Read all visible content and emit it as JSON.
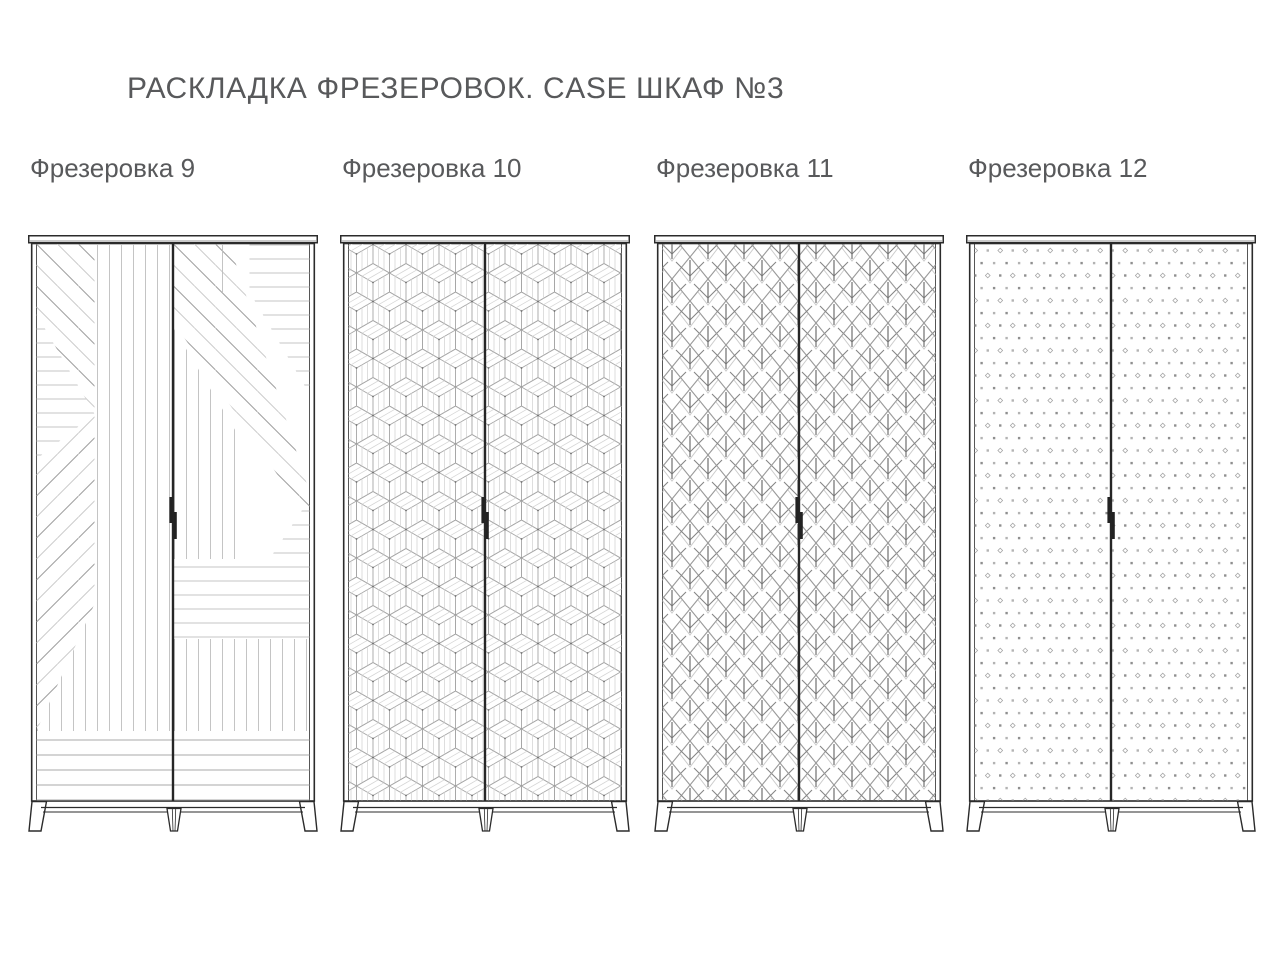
{
  "page": {
    "title": "РАСКЛАДКА ФРЕЗЕРОВОК. CASE ШКАФ №3",
    "background": "#ffffff"
  },
  "wardrobes": [
    {
      "label": "Фрезеровка 9",
      "pattern_name": "mixed-stripe-patchwork"
    },
    {
      "label": "Фрезеровка 10",
      "pattern_name": "isometric-cubes"
    },
    {
      "label": "Фрезеровка 11",
      "pattern_name": "art-deco-leaf-chevrons"
    },
    {
      "label": "Фрезеровка 12",
      "pattern_name": "dot-and-diamond-grid"
    }
  ],
  "colors": {
    "text": "#58595b",
    "outline": "#2b2b2b",
    "handle": "#222222",
    "pattern_light": "#c9c9c9",
    "pattern_mid": "#a6a6a6",
    "pattern_dark": "#7d7d7d",
    "background": "#ffffff"
  }
}
